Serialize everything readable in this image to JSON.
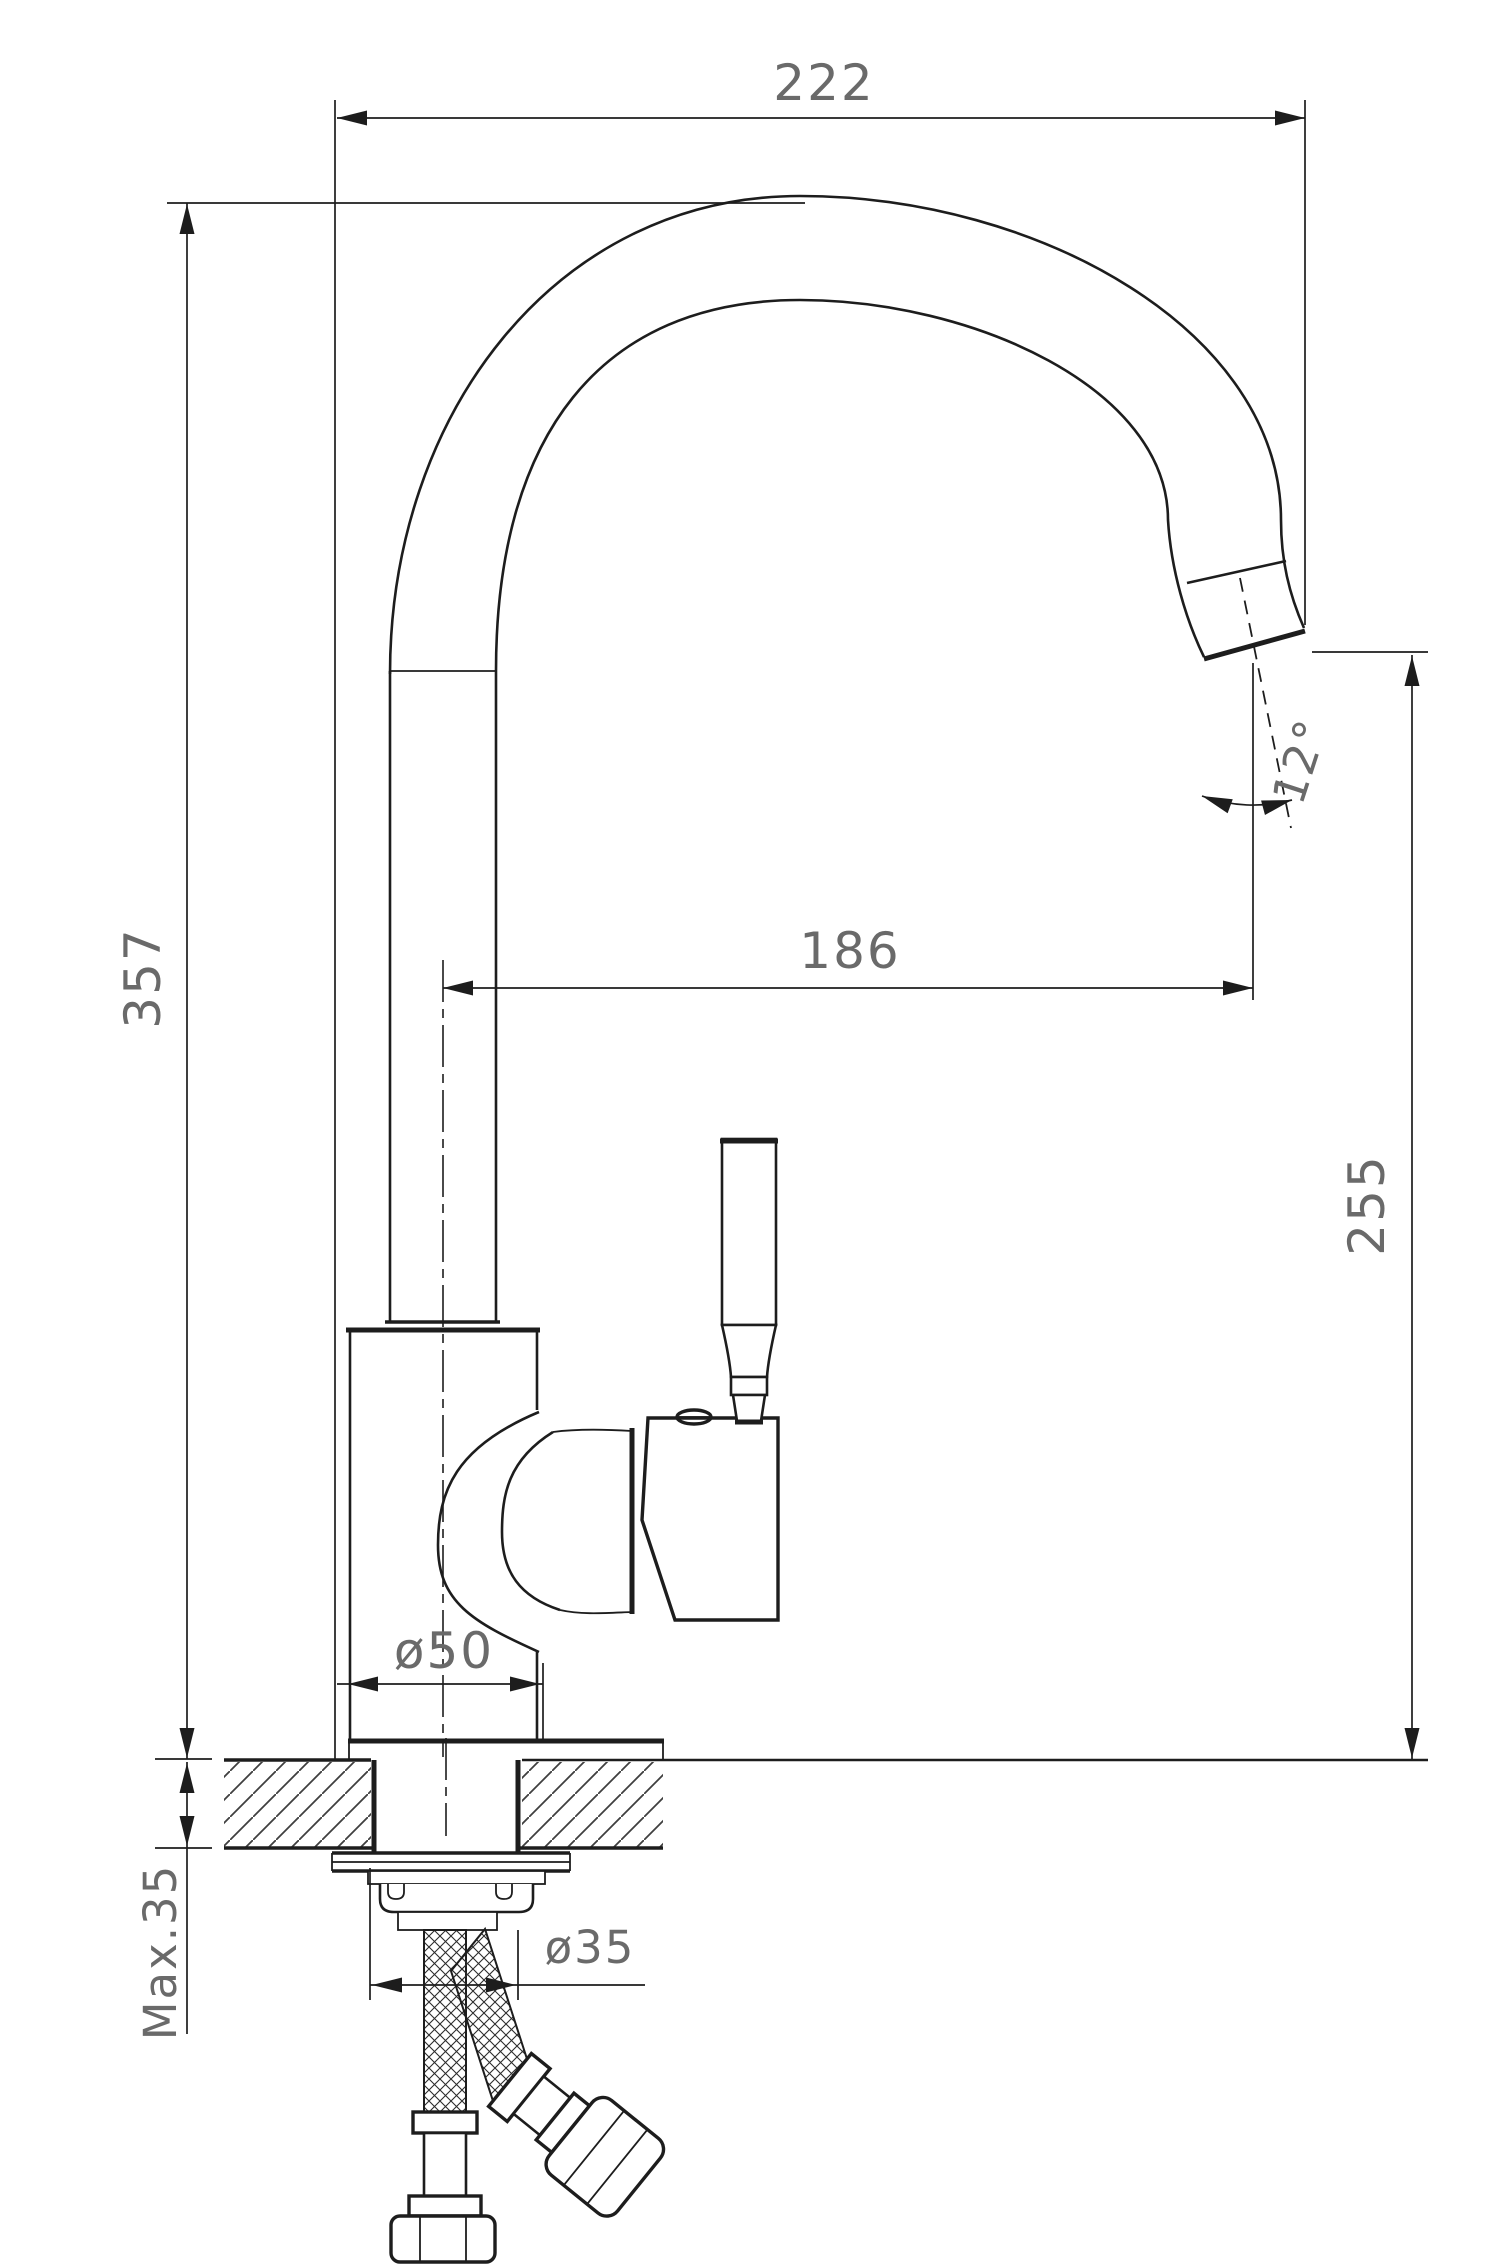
{
  "page": {
    "background": "#ffffff"
  },
  "colors": {
    "line": "#1d1d1d",
    "dim_text": "#6a6a6a",
    "hatch": "#3f3f3f"
  },
  "drawing": {
    "type": "technical-dimension-drawing",
    "view": "side elevation with counter mounting cross-section",
    "subject": "single-lever kitchen mixer tap with high-arc gooseneck spout and flexible supply hoses",
    "units": "mm",
    "dimensions": [
      {
        "id": "overall-width",
        "label": "222",
        "value": 222,
        "orientation": "horizontal",
        "meaning": "overall width of tap"
      },
      {
        "id": "overall-height",
        "label": "357",
        "value": 357,
        "orientation": "vertical",
        "meaning": "overall height above counter"
      },
      {
        "id": "spout-reach",
        "label": "186",
        "value": 186,
        "orientation": "horizontal",
        "meaning": "spout reach from body axis to outlet axis"
      },
      {
        "id": "outlet-height",
        "label": "255",
        "value": 255,
        "orientation": "vertical",
        "meaning": "outlet height above counter"
      },
      {
        "id": "outlet-angle",
        "label": "12°",
        "value": 12,
        "orientation": "angular",
        "meaning": "outlet angle from vertical"
      },
      {
        "id": "base-diameter",
        "label": "ø50",
        "value": 50,
        "orientation": "horizontal",
        "meaning": "base body diameter"
      },
      {
        "id": "shank-diameter",
        "label": "ø35",
        "value": 35,
        "orientation": "horizontal",
        "meaning": "mounting shank / hole diameter"
      },
      {
        "id": "max-deck-thickness",
        "label": "Max.35",
        "value": 35,
        "orientation": "vertical",
        "meaning": "maximum counter thickness"
      }
    ]
  }
}
